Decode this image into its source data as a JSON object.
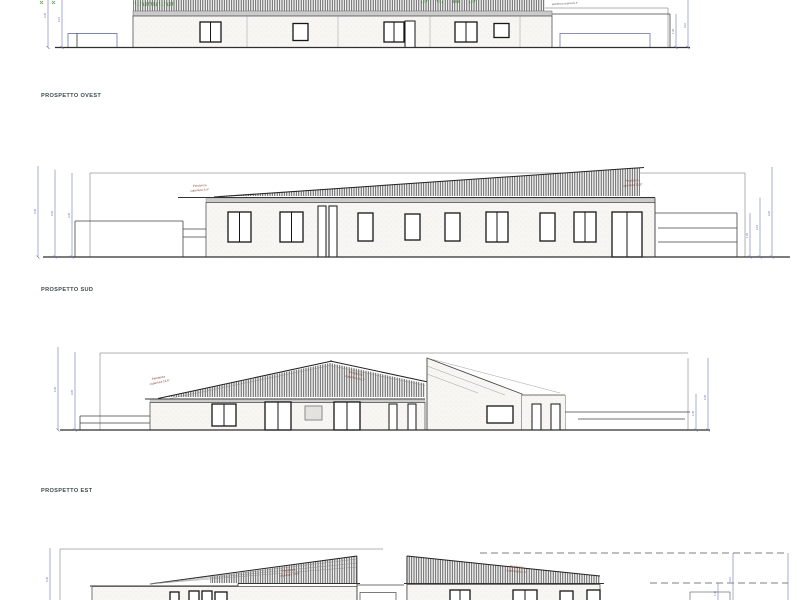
{
  "sheet": {
    "type": "architectural elevations drawing",
    "colors": {
      "dimension_blue": "#6a79b4",
      "annotation_red": "#8a4434",
      "label_color": "#3c4a4a",
      "roof_green": "#4a8a3f"
    }
  },
  "elevations": {
    "west": {
      "label": "PROSPETTO OVEST",
      "roof_note": "pendenza copertura 4°",
      "dims_left": [
        "3.45",
        "3.15"
      ],
      "dims_right": [
        "1.26",
        "3.10"
      ]
    },
    "sud": {
      "label": "PROSPETTO SUD",
      "roof_left_l1": "Pendenza",
      "roof_left_l2": "copertura 3.4°",
      "roof_right_l1": "Pendenza",
      "roof_right_l2": "copertura 11.3°",
      "dims_left": [
        "4.45",
        "4.05",
        "3.45"
      ],
      "dims_right": [
        "1.35",
        "2.16",
        "3.20"
      ]
    },
    "est": {
      "label": "PROSPETTO EST",
      "roof_left_l1": "Pendenza",
      "roof_left_l2": "copertura 13.6°",
      "roof_right_l1": "Pendenza",
      "roof_right_l2": "copertura 11.3°",
      "dims_left": [
        "4.45",
        "4.05"
      ],
      "dims_right": [
        "1.35",
        "4.45"
      ]
    },
    "north": {
      "roof_left_l1": "Pendenza",
      "roof_left_l2": "copertura 13.6°",
      "roof_right_l1": "Pendenza",
      "roof_right_l2": "copertura 11.6°",
      "dims_left": [
        "4.45"
      ],
      "dims_right": [
        "1.40",
        "3.10"
      ]
    }
  }
}
